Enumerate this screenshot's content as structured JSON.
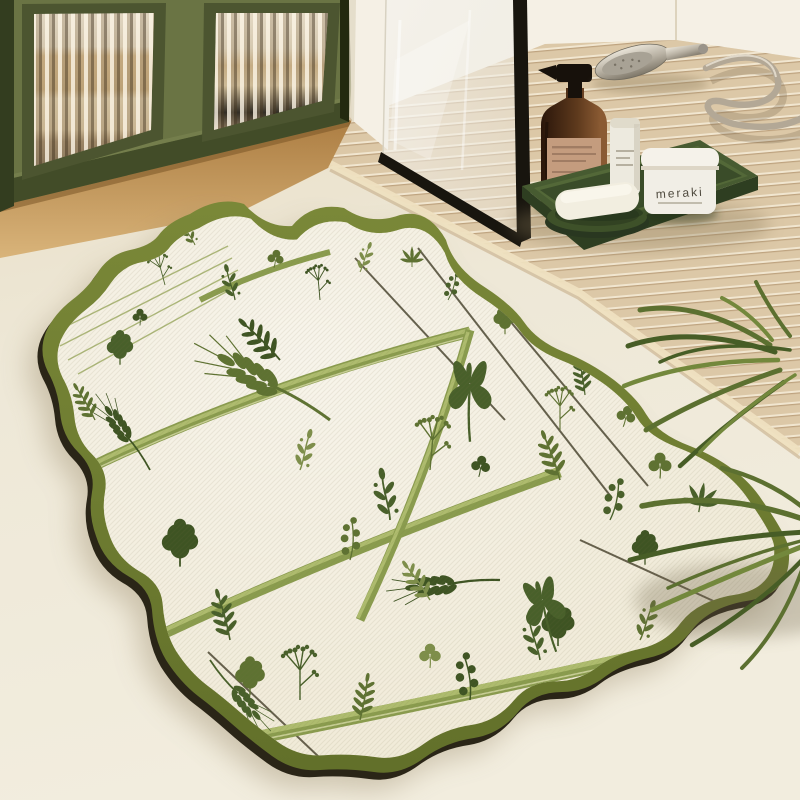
{
  "scene": {
    "description_objects": [
      "green-fluted-glass-cabinet",
      "white-wall",
      "shower-glass-panel",
      "wooden-slat-platform",
      "shower-handset",
      "shower-hose",
      "toiletry-tray",
      "amber-pump-bottle",
      "cosmetic-tube",
      "cosmetic-jar",
      "soap-dish",
      "soap-bar",
      "scalloped-botanical-rug",
      "palm-plant",
      "cream-floor"
    ]
  },
  "products": {
    "jar_label": "meraki"
  },
  "palette": {
    "floor_top": "#e7dbc1",
    "floor_main": "#eee8d7",
    "floor_light": "#f2edde",
    "wood_1": "#ab7c41",
    "wood_2": "#d9b47a",
    "cab_green": "#6a7444",
    "cab_green_dark": "#4c5530",
    "cab_rail": "#424c28",
    "cab_side": "#333d1f",
    "wall_white": "#f5f0e5",
    "frame_black": "#18150e",
    "slat_base": "#dcc8a7",
    "slat_light": "#f1e6d0",
    "slat_dark": "#bea37f",
    "edge_band": "#eee0c0",
    "tray_top": "#475b31",
    "tray_side": "#2e3e21",
    "tray_rim": "#5f7540",
    "amber_dark": "#2a160a",
    "amber_mid": "#5e3a1d",
    "amber_hi": "#8a5a33",
    "label_tan": "#c49c7e",
    "label_line": "#94725a",
    "pump_black": "#17110b",
    "tube_white": "#edeadf",
    "jar_white": "#f1eee6",
    "jar_text": "#4f4a3e",
    "dish_green": "#3e5129",
    "soap_white": "#f2eee0",
    "chrome_light": "#e9e4d8",
    "chrome_dark": "#7e7769",
    "hose": "#b3a896",
    "rug_base": "#f0ead7",
    "rug_border_1": "#7a8838",
    "rug_border_2": "#62702a",
    "rug_edge_dark": "#2a2517",
    "print_a": "#5e7232",
    "print_b": "#48602a",
    "print_c": "#7e8f4b",
    "print_d": "#3e5423",
    "stem_dark": "#55503c",
    "blade_1": "#8a9c4e",
    "blade_2": "#aebc6e",
    "palm_a": "#5c7030",
    "palm_b": "#475d26",
    "palm_c": "#73883c"
  }
}
